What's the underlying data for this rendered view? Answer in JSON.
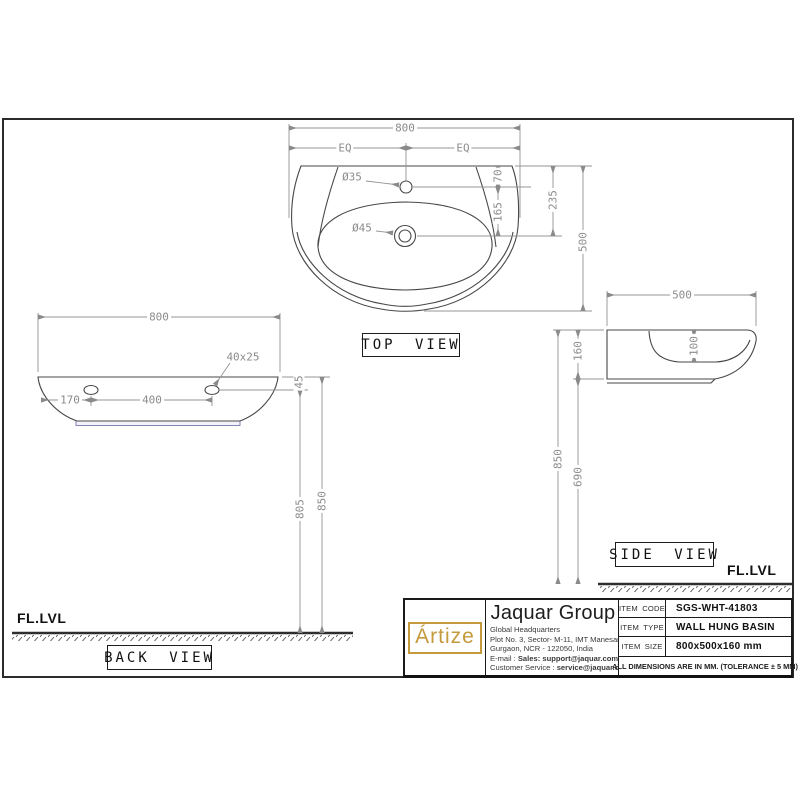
{
  "top_view": {
    "label": "TOP VIEW",
    "dim_width": "800",
    "dim_eq_left": "EQ",
    "dim_eq_right": "EQ",
    "faucet_hole_dia": "Ø35",
    "drain_hole_dia": "Ø45",
    "dim_top_to_faucet": "70",
    "dim_faucet_to_drain": "165",
    "dim_top_to_drain": "235",
    "dim_depth": "500"
  },
  "back_view": {
    "label": "BACK VIEW",
    "dim_width": "800",
    "mount_slot_size": "40x25",
    "dim_top_to_slot": "45",
    "dim_edge_to_slot": "170",
    "dim_slot_spacing": "400",
    "dim_slot_height": "805",
    "dim_rim_height": "850",
    "floor_label": "FL.LVL"
  },
  "side_view": {
    "label": "SIDE VIEW",
    "dim_depth": "500",
    "dim_height": "160",
    "dim_bowl_depth": "100",
    "dim_bottom_height": "690",
    "dim_rim_height": "850",
    "floor_label": "FL.LVL"
  },
  "title_block": {
    "logo": "Ártize",
    "company": "Jaquar Group",
    "address1": "Global Headquarters",
    "address2": "Plot No. 3, Sector- M-11, IMT Manesar",
    "address3": "Gurgaon, NCR - 122050, India",
    "email_label": "E-mail : ",
    "email_value": "Sales: support@jaquar.com",
    "service_label": "Customer Service : ",
    "service_value": "service@jaquar.com",
    "rows": [
      {
        "label": "ITEM CODE",
        "value": "SGS-WHT-41803"
      },
      {
        "label": "ITEM TYPE",
        "value": "WALL HUNG BASIN"
      },
      {
        "label": "ITEM SIZE",
        "value": "800x500x160 mm"
      }
    ],
    "note": "ALL DIMENSIONS ARE IN MM. (TOLERANCE ± 5 MM)"
  },
  "colors": {
    "outline": "#474747",
    "dimension": "#949494",
    "accent_gold": "#c49a3c",
    "gasket_blue": "#8585b5"
  }
}
